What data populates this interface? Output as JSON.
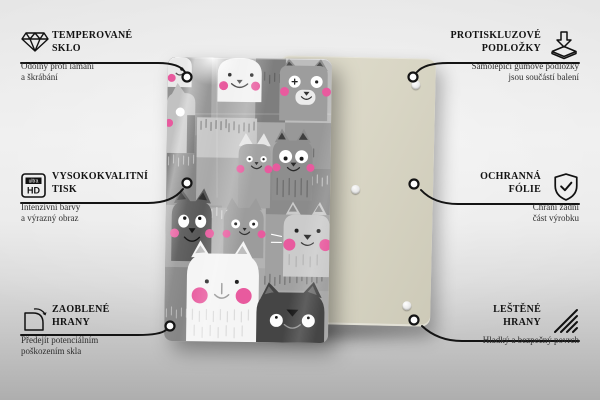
{
  "features": {
    "left": [
      {
        "icon_name": "diamond-icon",
        "title_line1": "TEMPEROVANÉ",
        "title_line2": "SKLO",
        "desc_line1": "Odolný proti lámání",
        "desc_line2": "a škrábání"
      },
      {
        "icon_name": "ultra-hd-icon",
        "title_line1": "VYSOKOKVALITNÍ",
        "title_line2": "TISK",
        "desc_line1": "Intenzivní barvy",
        "desc_line2": "a výrazný obraz"
      },
      {
        "icon_name": "rounded-corner-icon",
        "title_line1": "ZAOBLENÉ",
        "title_line2": "HRANY",
        "desc_line1": "Předejít potenciálním",
        "desc_line2": "poškozením skla"
      }
    ],
    "right": [
      {
        "icon_name": "anti-slip-pad-icon",
        "title_line1": "PROTISKLUZOVÉ",
        "title_line2": "PODLOŽKY",
        "desc_line1": "Samolepicí gumové podložky",
        "desc_line2": "jsou součástí balení"
      },
      {
        "icon_name": "shield-check-icon",
        "title_line1": "OCHRANNÁ",
        "title_line2": "FÓLIE",
        "desc_line1": "Chrání zadní",
        "desc_line2": "část výrobku"
      },
      {
        "icon_name": "polished-edge-icon",
        "title_line1": "LEŠTĚNÉ",
        "title_line2": "HRANY",
        "desc_line1": "Hladký a bezpečný povrch",
        "desc_line2": ""
      }
    ]
  },
  "icons": {
    "ultra_hd_top": "ultra",
    "ultra_hd_bottom": "HD"
  },
  "colors": {
    "accent_pink": "#e85a9e",
    "back_panel_beige": "#d8d5c4",
    "dark_cat_gray": "#454545",
    "line_black": "#141414"
  }
}
